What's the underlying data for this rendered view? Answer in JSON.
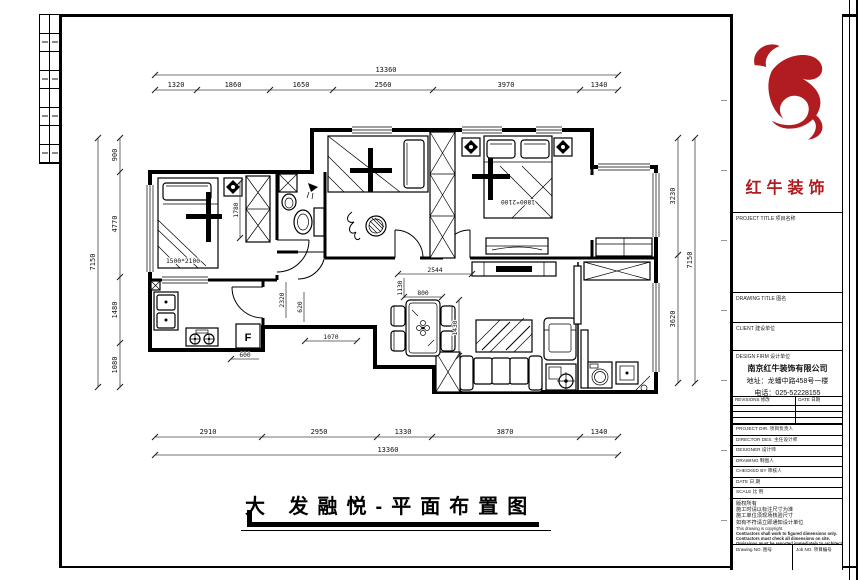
{
  "sheet": {
    "logo_text": "红牛装饰",
    "project_title_label": "PROJECT TITLE 项目名称",
    "drawing_title_label": "DRAWING TITLE 图名",
    "client_label": "CLIENT 建设单位",
    "design_firm_label": "DESIGN FIRM 设计单位",
    "firm_name": "南京红牛装饰有限公司",
    "firm_address": "地址：龙蟠中路458号一楼",
    "firm_phone": "电话：025-52228155",
    "revisions_label": "REVISIONS 修改",
    "date_col_label": "DATE 日期",
    "fields": [
      {
        "label": "PROJECT DIR. 项目负责人"
      },
      {
        "label": "DIRECTOR DES. 主任设计师"
      },
      {
        "label": "DESIGNER 设计师"
      },
      {
        "label": "DRAWING 制图人"
      },
      {
        "label": "CHECKED BY 审核人"
      },
      {
        "label": "DATE 日 期"
      },
      {
        "label": "SCALE 比 例"
      }
    ],
    "notes_cn": [
      "版权所有",
      "施工时请以标注尺寸为准",
      "施工单位须现场核验尺寸",
      "如有不符请立即通知设计单位"
    ],
    "notes_en": [
      "This drawing is copyright.",
      "Contractors shall work to figured dimensions only.",
      "Contractors must check all dimensions on site.",
      "Omissions must be reported immediately to architects."
    ],
    "drawing_no_label": "Drawing NO. 图号",
    "job_no_label": "Job NO. 项目编号"
  },
  "plan": {
    "title": "大 发融悦-平面布置图",
    "fridge_label": "F",
    "beds": {
      "left_bed": "1500*2100",
      "master_bed": "1800*2100"
    },
    "dims": {
      "top_total": "13360",
      "top": [
        "1320",
        "1860",
        "1650",
        "2560",
        "3970",
        "1340"
      ],
      "bottom": [
        "2910",
        "2950",
        "1330",
        "3870",
        "1340"
      ],
      "bottom_total": "13360",
      "left": [
        "900",
        "4770",
        "1480",
        "1080"
      ],
      "left_total": "7150",
      "right": [
        "3230",
        "3620"
      ],
      "right_total": "7150",
      "interior": {
        "hall_width": "2544",
        "entry": "1130",
        "table_w": "800",
        "table_l": "1430",
        "step": "1070",
        "kitchen": "600",
        "hall_a": "620",
        "hall_b": "2320",
        "wardrobe": "1780"
      }
    }
  }
}
